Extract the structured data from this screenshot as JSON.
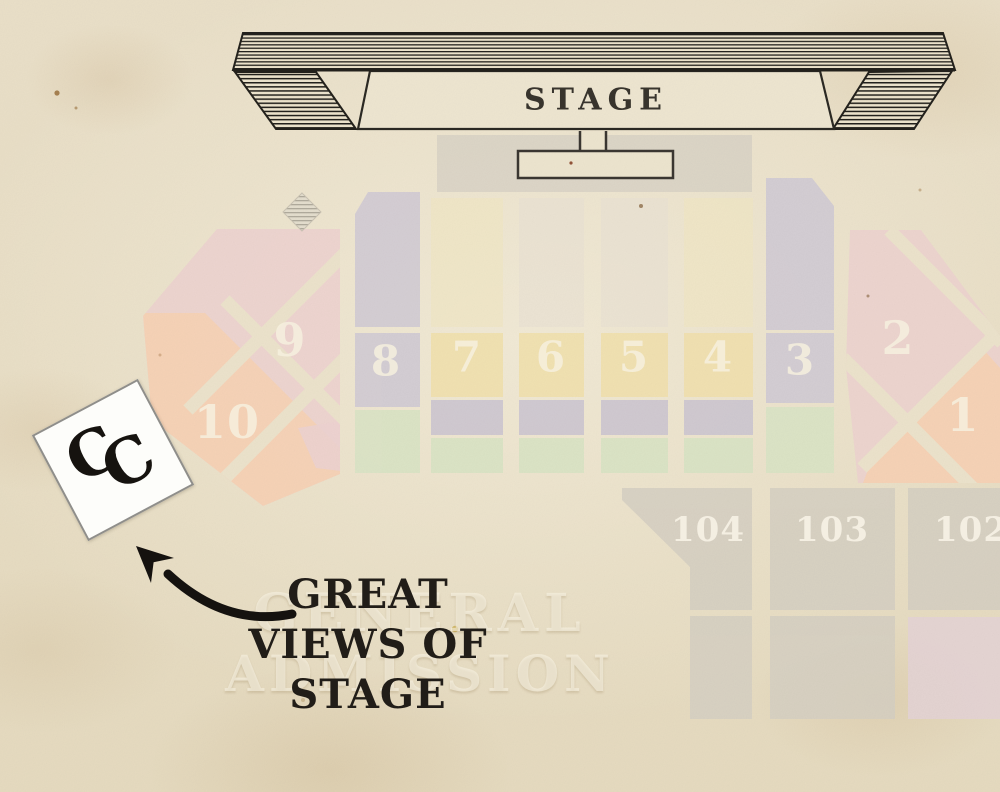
{
  "title": "Concert venue seating map",
  "stage": {
    "label": "STAGE"
  },
  "sections": {
    "s1": {
      "label": "1"
    },
    "s2": {
      "label": "2"
    },
    "s3": {
      "label": "3"
    },
    "s4": {
      "label": "4"
    },
    "s5": {
      "label": "5"
    },
    "s6": {
      "label": "6"
    },
    "s7": {
      "label": "7"
    },
    "s8": {
      "label": "8"
    },
    "s9": {
      "label": "9"
    },
    "s10": {
      "label": "10"
    },
    "s102": {
      "label": "102"
    },
    "s103": {
      "label": "103"
    },
    "s104": {
      "label": "104"
    }
  },
  "note": {
    "lines": [
      "GREAT",
      "VIEWS OF",
      "STAGE"
    ]
  },
  "watermark": {
    "lines": [
      "GENERAL",
      "ADMISSION"
    ]
  },
  "monogram": {
    "letters": [
      "C",
      "C"
    ]
  },
  "colors": {
    "paper": "#e9dfc8",
    "ink": "#23211c",
    "note_ink": "#211d18",
    "pink": "#ecd1cf",
    "orange": "#f6d2b4",
    "lavender": "#cfc9d4",
    "yellow": "#f1e0ac",
    "green": "#d8e3c4",
    "gray_block": "#d5cfc2",
    "floor_pink": "#e4d3d6",
    "label_cream": "#f6f0e0"
  }
}
